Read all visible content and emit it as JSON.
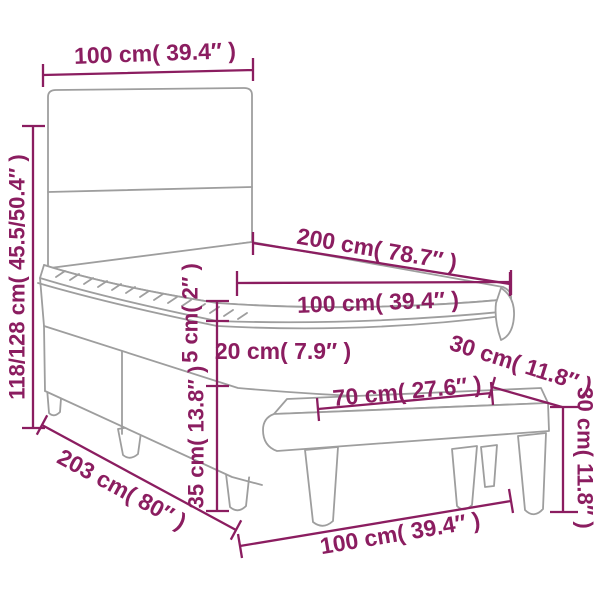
{
  "colors": {
    "dimension": "#8B1D60",
    "outline": "#9E9E9E",
    "background": "#FFFFFF"
  },
  "labels": {
    "headboard_width": "100 cm( 39.4″ )",
    "bed_height": "118/128 cm( 45.5/50.4″ )",
    "bed_length": "200 cm( 78.7″ )",
    "mattress_width": "100 cm( 39.4″ )",
    "topper_thickness": "5 cm( 2″ )",
    "mattress_thickness": "20 cm( 7.9″ )",
    "base_height": "35 cm( 13.8″ )",
    "diagonal_length": "203 cm( 80″ )",
    "front_width": "100 cm( 39.4″ )",
    "bench_length": "70 cm( 27.6″ )",
    "bench_depth": "30 cm( 11.8″ )",
    "bench_height": "30 cm( 11.8″ )"
  }
}
